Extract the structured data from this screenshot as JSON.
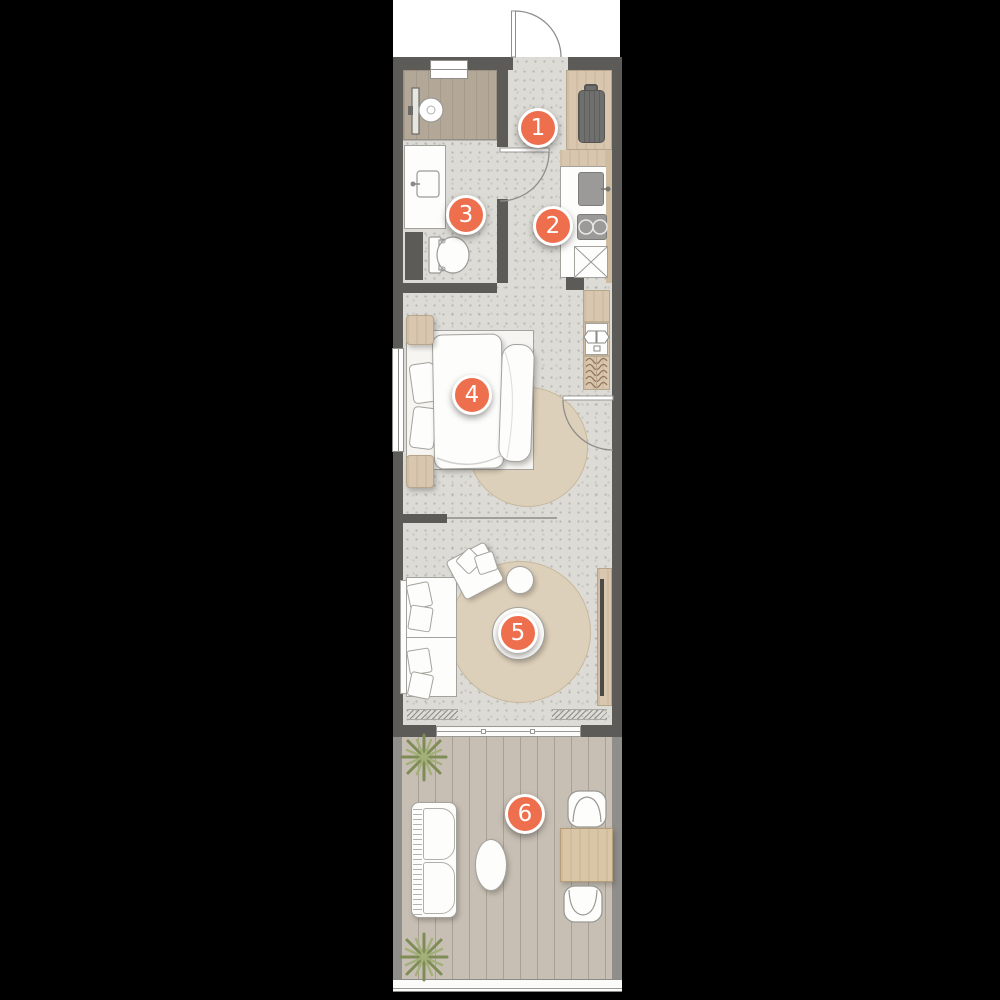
{
  "title": "apartment-floor-plan",
  "colors": {
    "accent": "#ee6f4e",
    "wall": "#5d5b58",
    "floor_speckle": "#dcdbd6",
    "wood": "#d8c6ae",
    "shower_floor": "#b3a898",
    "deck": "#c7bfb4",
    "rug": "#ddd0ba",
    "plant": "#93a266",
    "background": "#000000",
    "furniture_white": "#fdfdfc"
  },
  "markers": [
    {
      "number": "1",
      "x": 538,
      "y": 128
    },
    {
      "number": "2",
      "x": 553,
      "y": 226
    },
    {
      "number": "3",
      "x": 466,
      "y": 215
    },
    {
      "number": "4",
      "x": 472,
      "y": 395
    },
    {
      "number": "5",
      "x": 518,
      "y": 633
    },
    {
      "number": "6",
      "x": 525,
      "y": 814
    }
  ]
}
